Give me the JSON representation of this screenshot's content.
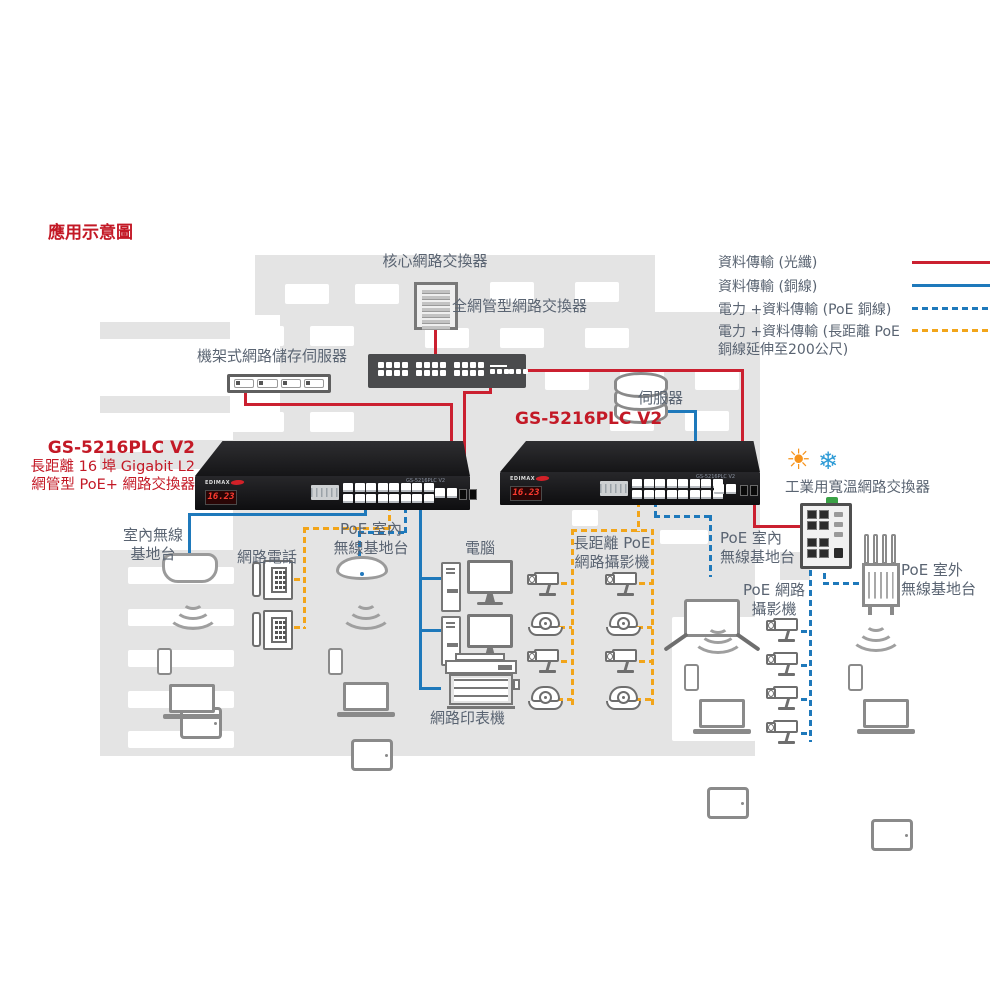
{
  "title": "應用示意圖",
  "legend": {
    "items": [
      {
        "label": "資料傳輸 (光纖)",
        "line": "solid-red"
      },
      {
        "label": "資料傳輸 (銅線)",
        "line": "solid-blue"
      },
      {
        "label": "電力 +資料傳輸 (PoE 銅線)",
        "line": "dashed-blue"
      },
      {
        "label": "電力 +資料傳輸 (長距離 PoE 銅線延伸至200公尺)",
        "line": "dashed-orange"
      }
    ]
  },
  "colors": {
    "fiber_red": "#cb2030",
    "copper_blue": "#1e79bb",
    "poe_long_orange": "#f2a51a",
    "label_gray": "#5a6472",
    "accent_red_text": "#c31926",
    "building_gray": "#e4e4e4"
  },
  "nodes": {
    "core_switch": "核心網路交換器",
    "managed_switch": "全網管型網路交換器",
    "nas": "機架式網路儲存伺服器",
    "server": "伺服器",
    "gs_model": "GS-5216PLC V2",
    "gs_desc1": "長距離 16 埠 Gigabit L2",
    "gs_desc2": "網管型 PoE+ 網路交換器",
    "indoor_ap": "室內無線\n基地台",
    "ip_phone": "網路電話",
    "poe_indoor_ap": "PoE 室內\n無線基地台",
    "computer": "電腦",
    "long_reach_cam": "長距離 PoE\n網路攝影機",
    "printer": "網路印表機",
    "poe_cam": "PoE 網路\n攝影機",
    "industrial_switch": "工業用寬溫網路交換器",
    "outdoor_ap": "PoE 室外\n無線基地台"
  },
  "device": {
    "brand": "EDIMAX",
    "led_display": "16.23",
    "model_tag": "GS-5216PLC V2"
  }
}
